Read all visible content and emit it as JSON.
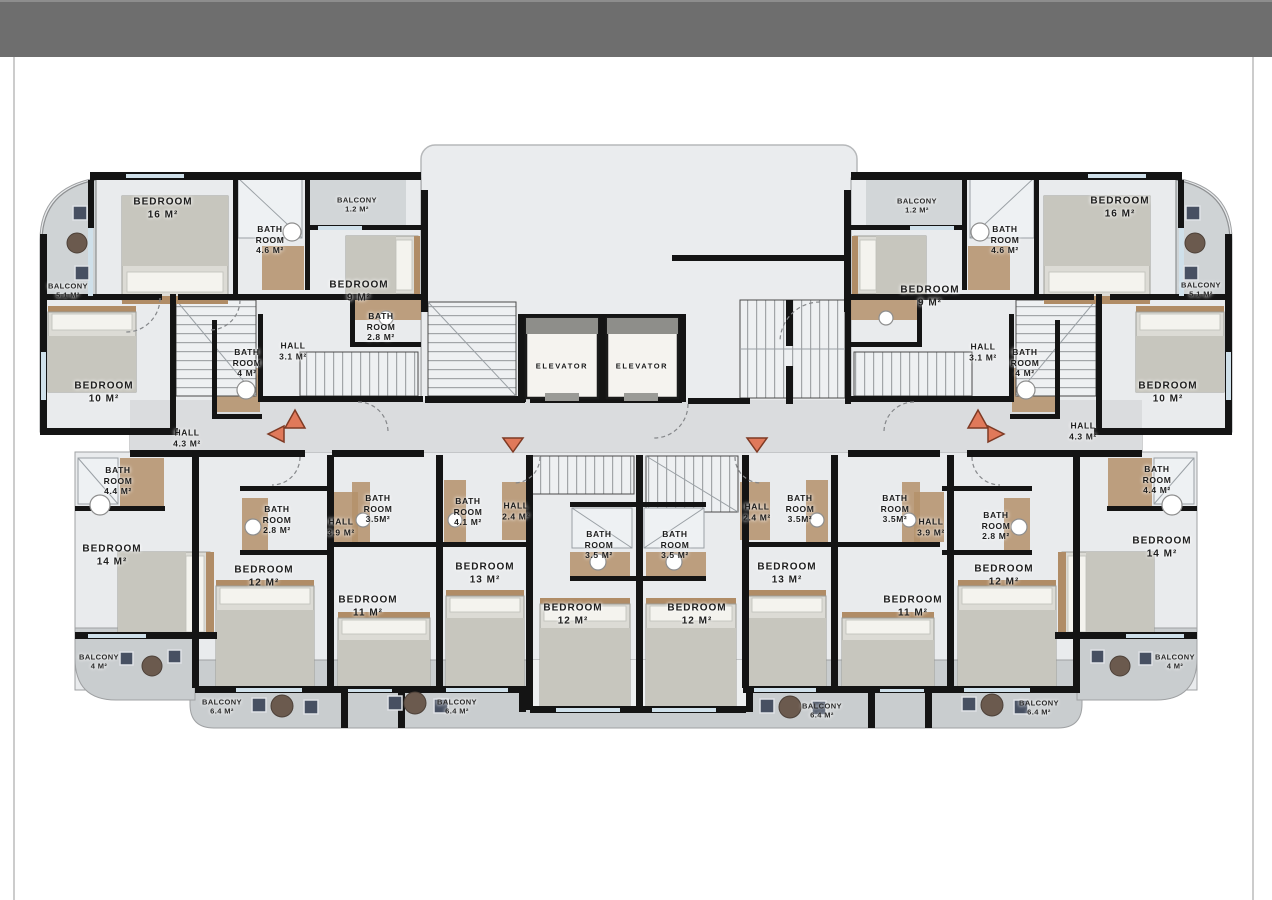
{
  "colors": {
    "topbar": "#6e6e6e",
    "wall": "#141414",
    "floor_light": "#e9ebed",
    "floor_corridor": "#dadcde",
    "balcony_floor": "#c9cdcf",
    "wood_accent": "#b4906a",
    "window_glass": "#cfe0ea",
    "direction_triangle": "#e0795a"
  },
  "labels": [
    {
      "id": "bedroom-16-left",
      "text": "BEDROOM\n16 M²"
    },
    {
      "id": "bathroom-4-6-left",
      "text": "BATH\nROOM\n4.6 M²"
    },
    {
      "id": "balcony-1-2-left",
      "text": "BALCONY\n1.2 M²"
    },
    {
      "id": "balcony-5-1-left",
      "text": "BALCONY\n5.1 M²"
    },
    {
      "id": "bedroom-9-left",
      "text": "BEDROOM\n9 M²"
    },
    {
      "id": "bathroom-2-8-upper-left",
      "text": "BATH\nROOM\n2.8 M²"
    },
    {
      "id": "hall-3-1-left",
      "text": "HALL\n3.1 M²"
    },
    {
      "id": "bathroom-4-left",
      "text": "BATH\nROOM\n4 M²"
    },
    {
      "id": "bedroom-10-left",
      "text": "BEDROOM\n10 M²"
    },
    {
      "id": "hall-4-3-left",
      "text": "HALL\n4.3 M²"
    },
    {
      "id": "bathroom-4-4-left",
      "text": "BATH\nROOM\n4.4 M²"
    },
    {
      "id": "bedroom-14-left",
      "text": "BEDROOM\n14 M²"
    },
    {
      "id": "balcony-4-left",
      "text": "BALCONY\n4 M²"
    },
    {
      "id": "bathroom-2-8-lower-left",
      "text": "BATH\nROOM\n2.8 M²"
    },
    {
      "id": "hall-3-9-left",
      "text": "HALL\n3.9 M²"
    },
    {
      "id": "bathroom-3-5-lower-left",
      "text": "BATH\nROOM\n3.5M²"
    },
    {
      "id": "bedroom-12-lower-left",
      "text": "BEDROOM\n12 M²"
    },
    {
      "id": "bedroom-11-left",
      "text": "BEDROOM\n11 M²"
    },
    {
      "id": "balcony-6-4-a",
      "text": "BALCONY\n6.4 M²"
    },
    {
      "id": "balcony-6-4-b",
      "text": "BALCONY\n6.4 M²"
    },
    {
      "id": "bathroom-4-1-center",
      "text": "BATH\nROOM\n4.1 M²"
    },
    {
      "id": "hall-2-4-left",
      "text": "HALL\n2.4 M²"
    },
    {
      "id": "bedroom-13-left",
      "text": "BEDROOM\n13 M²"
    },
    {
      "id": "bathroom-3-5-center-1",
      "text": "BATH\nROOM\n3.5 M²"
    },
    {
      "id": "bathroom-3-5-center-2",
      "text": "BATH\nROOM\n3.5 M²"
    },
    {
      "id": "bedroom-12-center-1",
      "text": "BEDROOM\n12 M²"
    },
    {
      "id": "bedroom-12-center-2",
      "text": "BEDROOM\n12 M²"
    },
    {
      "id": "hall-2-4-right",
      "text": "HALL\n2.4 M²"
    },
    {
      "id": "bathroom-3-5-upper-right",
      "text": "BATH\nROOM\n3.5M²"
    },
    {
      "id": "bedroom-13-right",
      "text": "BEDROOM\n13 M²"
    },
    {
      "id": "bathroom-3-5-lower-right",
      "text": "BATH\nROOM\n3.5M²"
    },
    {
      "id": "hall-3-9-right",
      "text": "HALL\n3.9 M²"
    },
    {
      "id": "bathroom-2-8-lower-right",
      "text": "BATH\nROOM\n2.8 M²"
    },
    {
      "id": "bedroom-11-right",
      "text": "BEDROOM\n11 M²"
    },
    {
      "id": "bedroom-12-lower-right",
      "text": "BEDROOM\n12 M²"
    },
    {
      "id": "balcony-6-4-c",
      "text": "BALCONY\n6.4 M²"
    },
    {
      "id": "balcony-6-4-d",
      "text": "BALCONY\n6.4 M²"
    },
    {
      "id": "balcony-1-2-right",
      "text": "BALCONY\n1.2 M²"
    },
    {
      "id": "bathroom-4-6-right",
      "text": "BATH\nROOM\n4.6 M²"
    },
    {
      "id": "bedroom-16-right",
      "text": "BEDROOM\n16 M²"
    },
    {
      "id": "bedroom-9-right",
      "text": "BEDROOM\n9 M²"
    },
    {
      "id": "balcony-5-1-right",
      "text": "BALCONY\n5.1 M²"
    },
    {
      "id": "hall-3-1-right",
      "text": "HALL\n3.1 M²"
    },
    {
      "id": "bathroom-4-right",
      "text": "BATH\nROOM\n4 M²"
    },
    {
      "id": "bedroom-10-right",
      "text": "BEDROOM\n10 M²"
    },
    {
      "id": "hall-4-3-right",
      "text": "HALL\n4.3 M²"
    },
    {
      "id": "bathroom-4-4-right",
      "text": "BATH\nROOM\n4.4 M²"
    },
    {
      "id": "bedroom-14-right",
      "text": "BEDROOM\n14 M²"
    },
    {
      "id": "balcony-4-right",
      "text": "BALCONY\n4 M²"
    },
    {
      "id": "elevator-1",
      "text": "ELEVATOR"
    },
    {
      "id": "elevator-2",
      "text": "ELEVATOR"
    }
  ]
}
